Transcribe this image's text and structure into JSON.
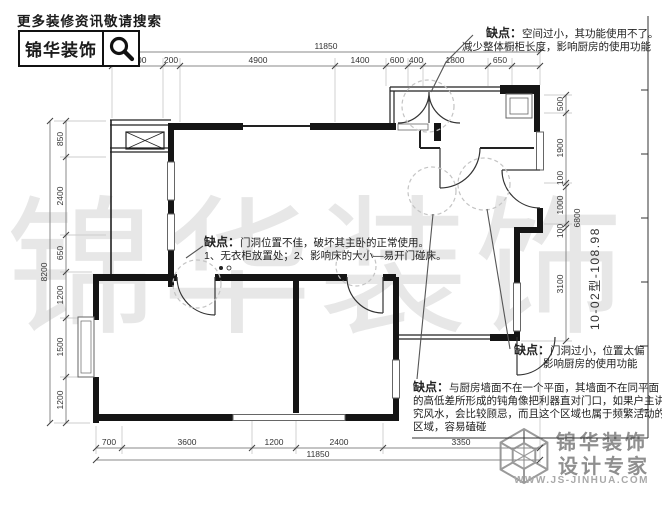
{
  "header": {
    "tagline": "更多装修资讯敬请搜索",
    "logo_text": "锦华装饰",
    "search_icon": "magnifier"
  },
  "watermark": "锦华装饰",
  "unit_label": "10-02型-108.98",
  "callouts": {
    "c1": {
      "label": "缺点：",
      "line1": "空间过小，其功能使用不了。",
      "line2": "减少整体橱柜长度，影响厨房的使用功能"
    },
    "c2": {
      "label": "缺点：",
      "line1": "门洞位置不佳，破坏其主卧的正常使用。",
      "line2": "1、无衣柜放置处；2、影响床的大小—易开门碰床。"
    },
    "c3": {
      "label": "缺点：",
      "line1": "门洞过小，位置太偏",
      "line2": "影响厨房的使用功能"
    },
    "c4": {
      "label": "缺点：",
      "text": "与厨房墙面不在一个平面，其墙面不在同平面的高低差所形成的钝角像把利器直对门口，如果户主讲究风水，会比较顾忌，而且这个区域也属于频繁活动的区域，容易磕碰"
    }
  },
  "dims": {
    "top_total": "11850",
    "top": [
      "1400",
      "200",
      "4900",
      "1400",
      "600",
      "400",
      "1800",
      "650"
    ],
    "left_total": "8200",
    "left": [
      "850",
      "2400",
      "650",
      "1200",
      "1500",
      "1200"
    ],
    "right_total": "6800",
    "right": [
      "500",
      "1900",
      "100",
      "1000",
      "100",
      "3100"
    ],
    "bottom_total": "11850",
    "bottom": [
      "700",
      "3600",
      "1200",
      "2400",
      "3350"
    ]
  },
  "footer": {
    "brand_line1": "锦华装饰",
    "brand_line2": "设计专家",
    "url": "WWW.JS-JINHUA.COM"
  }
}
